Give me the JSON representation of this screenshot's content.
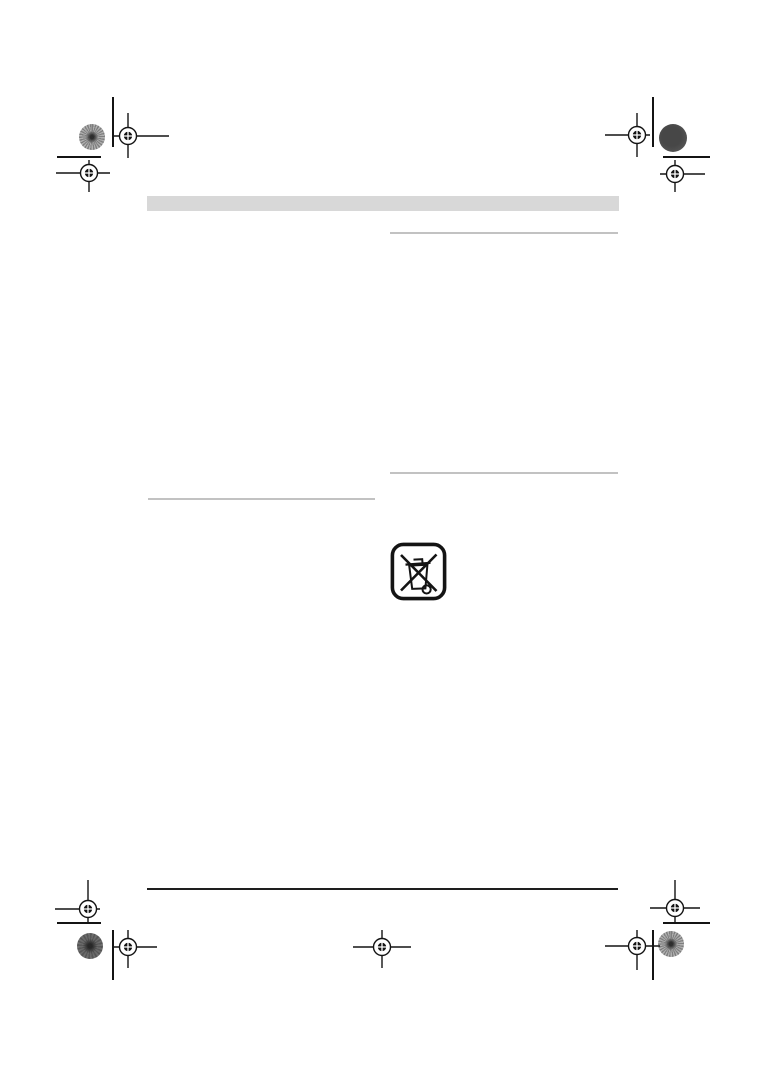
{
  "page_type": "instruction-manual-print-proof-page",
  "colors": {
    "page_bg": "#ffffff",
    "header_band": "#d8d8d8",
    "section_rule": "#c2c2c2",
    "footer_rule": "#1e1e1e",
    "mark_ink": "#141414",
    "patch_light_gray": "#909090",
    "patch_dark_gray": "#525252"
  },
  "header_band": {
    "text": ""
  },
  "icons": {
    "weee_symbol": "weee-crossed-out-wheelie-bin-icon",
    "registration_mark": "printer-registration-mark-icon",
    "color_patch": "print-color-control-patch-icon"
  }
}
